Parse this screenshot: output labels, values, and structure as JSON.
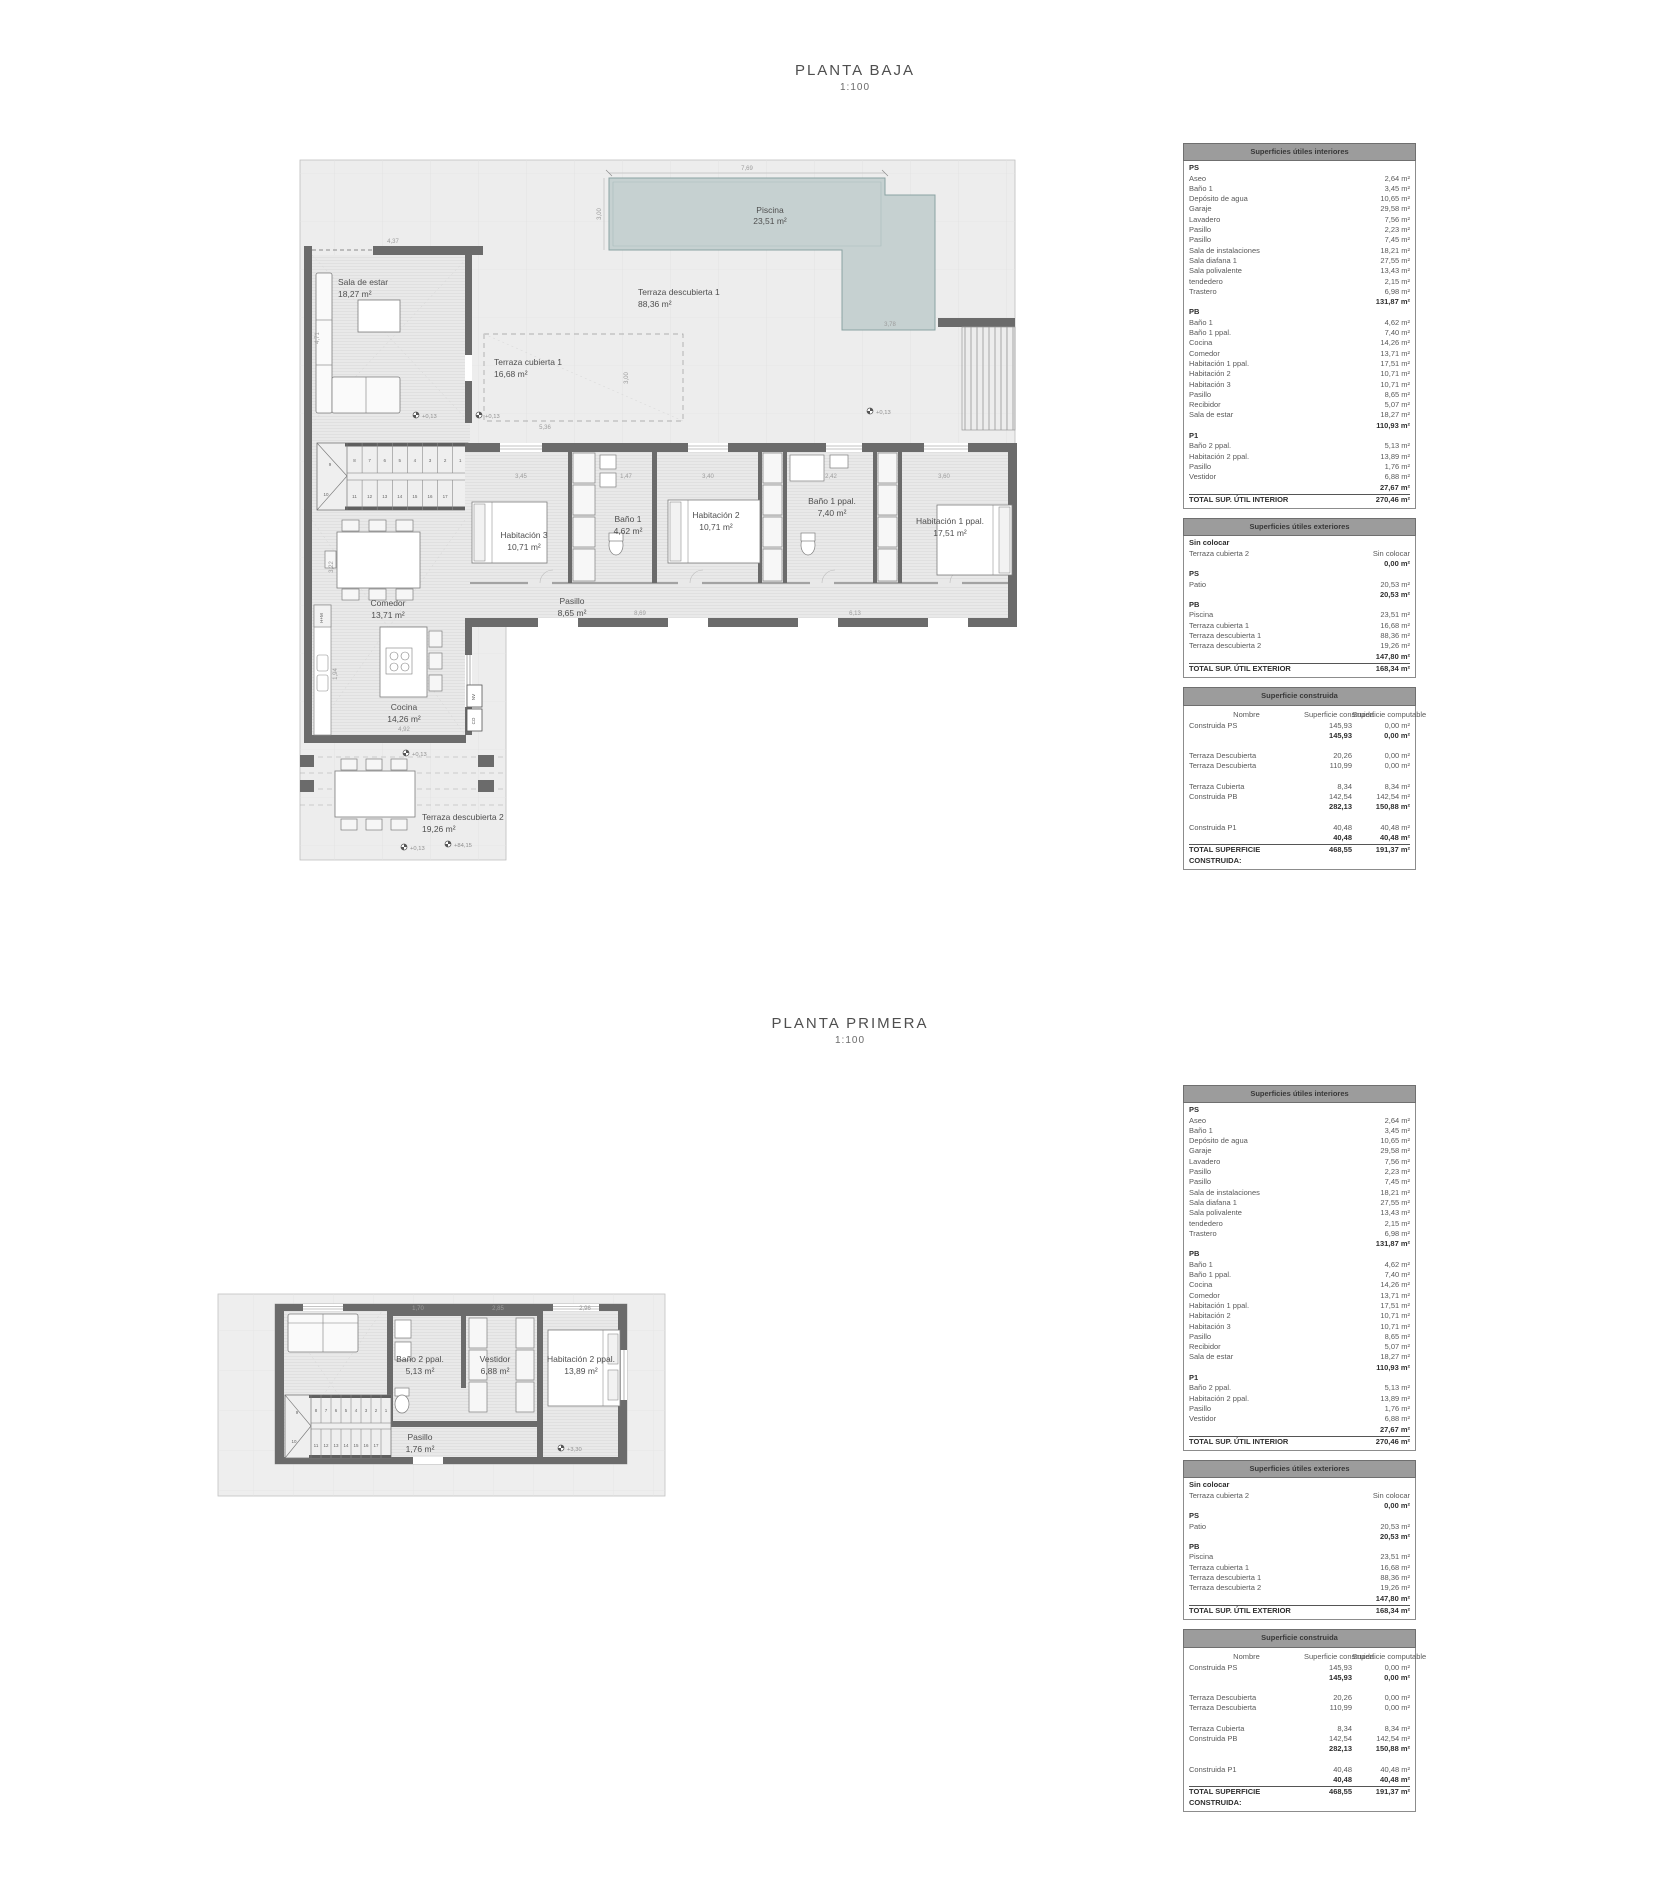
{
  "plans": {
    "pb": {
      "title": "PLANTA BAJA",
      "scale": "1:100",
      "rooms": {
        "piscina": {
          "name": "Piscina",
          "area": "23,51 m²"
        },
        "td1": {
          "name": "Terraza descubierta 1",
          "area": "88,36 m²"
        },
        "tc1": {
          "name": "Terraza cubierta 1",
          "area": "16,68 m²"
        },
        "sala": {
          "name": "Sala de estar",
          "area": "18,27 m²"
        },
        "recibidor": {
          "name": "Recibidor",
          "area": "5,07 m²"
        },
        "hab3": {
          "name": "Habitación 3",
          "area": "10,71 m²"
        },
        "bano1": {
          "name": "Baño 1",
          "area": "4,62 m²"
        },
        "hab2": {
          "name": "Habitación 2",
          "area": "10,71 m²"
        },
        "bano1ppal": {
          "name": "Baño 1 ppal.",
          "area": "7,40 m²"
        },
        "hab1ppal": {
          "name": "Habitación 1 ppal.",
          "area": "17,51 m²"
        },
        "comedor": {
          "name": "Comedor",
          "area": "13,71 m²"
        },
        "pasillo": {
          "name": "Pasillo",
          "area": "8,65 m²"
        },
        "cocina": {
          "name": "Cocina",
          "area": "14,26 m²"
        },
        "td2": {
          "name": "Terraza descubierta 2",
          "area": "19,26 m²"
        }
      },
      "dims": {
        "pool_w": "7,69",
        "pool_h": "3,00",
        "pool_arm": "3,78",
        "sala_w": "4,37",
        "sala_h": "4,71",
        "tc1_w": "5,36",
        "tc1_h": "3,00",
        "hab3_w": "3,45",
        "bano1_w": "1,47",
        "hab2_w": "3,40",
        "bano1ppal_w": "2,42",
        "hab1ppal_w": "3,60",
        "pasillo_l": "8,69",
        "hab1ppal_d": "6,13",
        "comedor_h": "3,22",
        "counter_h": "1,94",
        "cocina_w": "4,92"
      },
      "elevations": {
        "e013": "+0,13",
        "e8415": "+84,15"
      }
    },
    "p1": {
      "title": "PLANTA PRIMERA",
      "scale": "1:100",
      "rooms": {
        "bano2ppal": {
          "name": "Baño 2 ppal.",
          "area": "5,13 m²"
        },
        "vestidor": {
          "name": "Vestidor",
          "area": "6,88 m²"
        },
        "hab2ppal": {
          "name": "Habitación 2 ppal.",
          "area": "13,89 m²"
        },
        "pasillo": {
          "name": "Pasillo",
          "area": "1,76 m²"
        }
      },
      "dims": {
        "d1": "1,70",
        "d2": "2,85",
        "d3": "2,96"
      },
      "elevations": {
        "e330": "+3,30"
      }
    }
  },
  "stairs": {
    "run_upper": [
      "8",
      "7",
      "6",
      "5",
      "4",
      "3",
      "2",
      "1"
    ],
    "mid": [
      "9",
      "10"
    ],
    "run_lower": [
      "11",
      "12",
      "13",
      "14",
      "15",
      "16",
      "17"
    ]
  },
  "tables": {
    "interiores": {
      "title": "Superficies útiles interiores",
      "sections": [
        {
          "name": "PS",
          "rows": [
            [
              "Aseo",
              "2,64 m²"
            ],
            [
              "Baño 1",
              "3,45 m²"
            ],
            [
              "Depósito de agua",
              "10,65 m²"
            ],
            [
              "Garaje",
              "29,58 m²"
            ],
            [
              "Lavadero",
              "7,56 m²"
            ],
            [
              "Pasillo",
              "2,23 m²"
            ],
            [
              "Pasillo",
              "7,45 m²"
            ],
            [
              "Sala de instalaciones",
              "18,21 m²"
            ],
            [
              "Sala diafana 1",
              "27,55 m²"
            ],
            [
              "Sala polivalente",
              "13,43 m²"
            ],
            [
              "tendedero",
              "2,15 m²"
            ],
            [
              "Trastero",
              "6,98 m²"
            ]
          ],
          "subtotal": "131,87 m²"
        },
        {
          "name": "PB",
          "rows": [
            [
              "Baño 1",
              "4,62 m²"
            ],
            [
              "Baño 1 ppal.",
              "7,40 m²"
            ],
            [
              "Cocina",
              "14,26 m²"
            ],
            [
              "Comedor",
              "13,71 m²"
            ],
            [
              "Habitación 1 ppal.",
              "17,51 m²"
            ],
            [
              "Habitación 2",
              "10,71 m²"
            ],
            [
              "Habitación 3",
              "10,71 m²"
            ],
            [
              "Pasillo",
              "8,65 m²"
            ],
            [
              "Recibidor",
              "5,07 m²"
            ],
            [
              "Sala de estar",
              "18,27 m²"
            ]
          ],
          "subtotal": "110,93 m²"
        },
        {
          "name": "P1",
          "rows": [
            [
              "Baño 2 ppal.",
              "5,13 m²"
            ],
            [
              "Habitación 2 ppal.",
              "13,89 m²"
            ],
            [
              "Pasillo",
              "1,76 m²"
            ],
            [
              "Vestidor",
              "6,88 m²"
            ]
          ],
          "subtotal": "27,67 m²"
        }
      ],
      "total_label": "TOTAL SUP.  ÚTIL INTERIOR",
      "total_value": "270,46 m²"
    },
    "exteriores": {
      "title": "Superficies útiles exteriores",
      "sections": [
        {
          "name": "Sin colocar",
          "rows": [
            [
              "Terraza cubierta 2",
              "Sin colocar"
            ]
          ],
          "subtotal": "0,00 m²"
        },
        {
          "name": "PS",
          "rows": [
            [
              "Patio",
              "20,53 m²"
            ]
          ],
          "subtotal": "20,53 m²"
        },
        {
          "name": "PB",
          "rows": [
            [
              "Piscina",
              "23,51 m²"
            ],
            [
              "Terraza cubierta 1",
              "16,68 m²"
            ],
            [
              "Terraza descubierta 1",
              "88,36 m²"
            ],
            [
              "Terraza descubierta 2",
              "19,26 m²"
            ]
          ],
          "subtotal": "147,80 m²"
        }
      ],
      "total_label": "TOTAL SUP.  ÚTIL EXTERIOR",
      "total_value": "168,34 m²"
    },
    "construida": {
      "title": "Superficie construida",
      "col_headers": [
        "Nombre",
        "Superficie construida",
        "Superficie computable"
      ],
      "groups": [
        {
          "rows": [
            [
              "Construida PS",
              "145,93",
              "0,00 m²"
            ]
          ],
          "subtotal": [
            "145,93",
            "0,00 m²"
          ]
        },
        {
          "rows": [
            [
              "Terraza Descubierta",
              "20,26",
              "0,00 m²"
            ],
            [
              "Terraza Descubierta",
              "110,99",
              "0,00 m²"
            ]
          ],
          "subtotal": null
        },
        {
          "rows": [
            [
              "Terraza Cubierta",
              "8,34",
              "8,34 m²"
            ],
            [
              "Construida PB",
              "142,54",
              "142,54 m²"
            ]
          ],
          "subtotal": [
            "282,13",
            "150,88 m²"
          ]
        },
        {
          "rows": [
            [
              "Construida P1",
              "40,48",
              "40,48 m²"
            ]
          ],
          "subtotal": [
            "40,48",
            "40,48 m²"
          ]
        }
      ],
      "total": [
        "TOTAL SUPERFICIE CONSTRUIDA:",
        "468,55",
        "191,37 m²"
      ]
    }
  },
  "colors": {
    "pool_fill": "#c6d1d1",
    "pool_stroke": "#8aa2a2",
    "terrace": "#ededed",
    "wall": "#616161",
    "table_header": "#9c9c9c"
  }
}
